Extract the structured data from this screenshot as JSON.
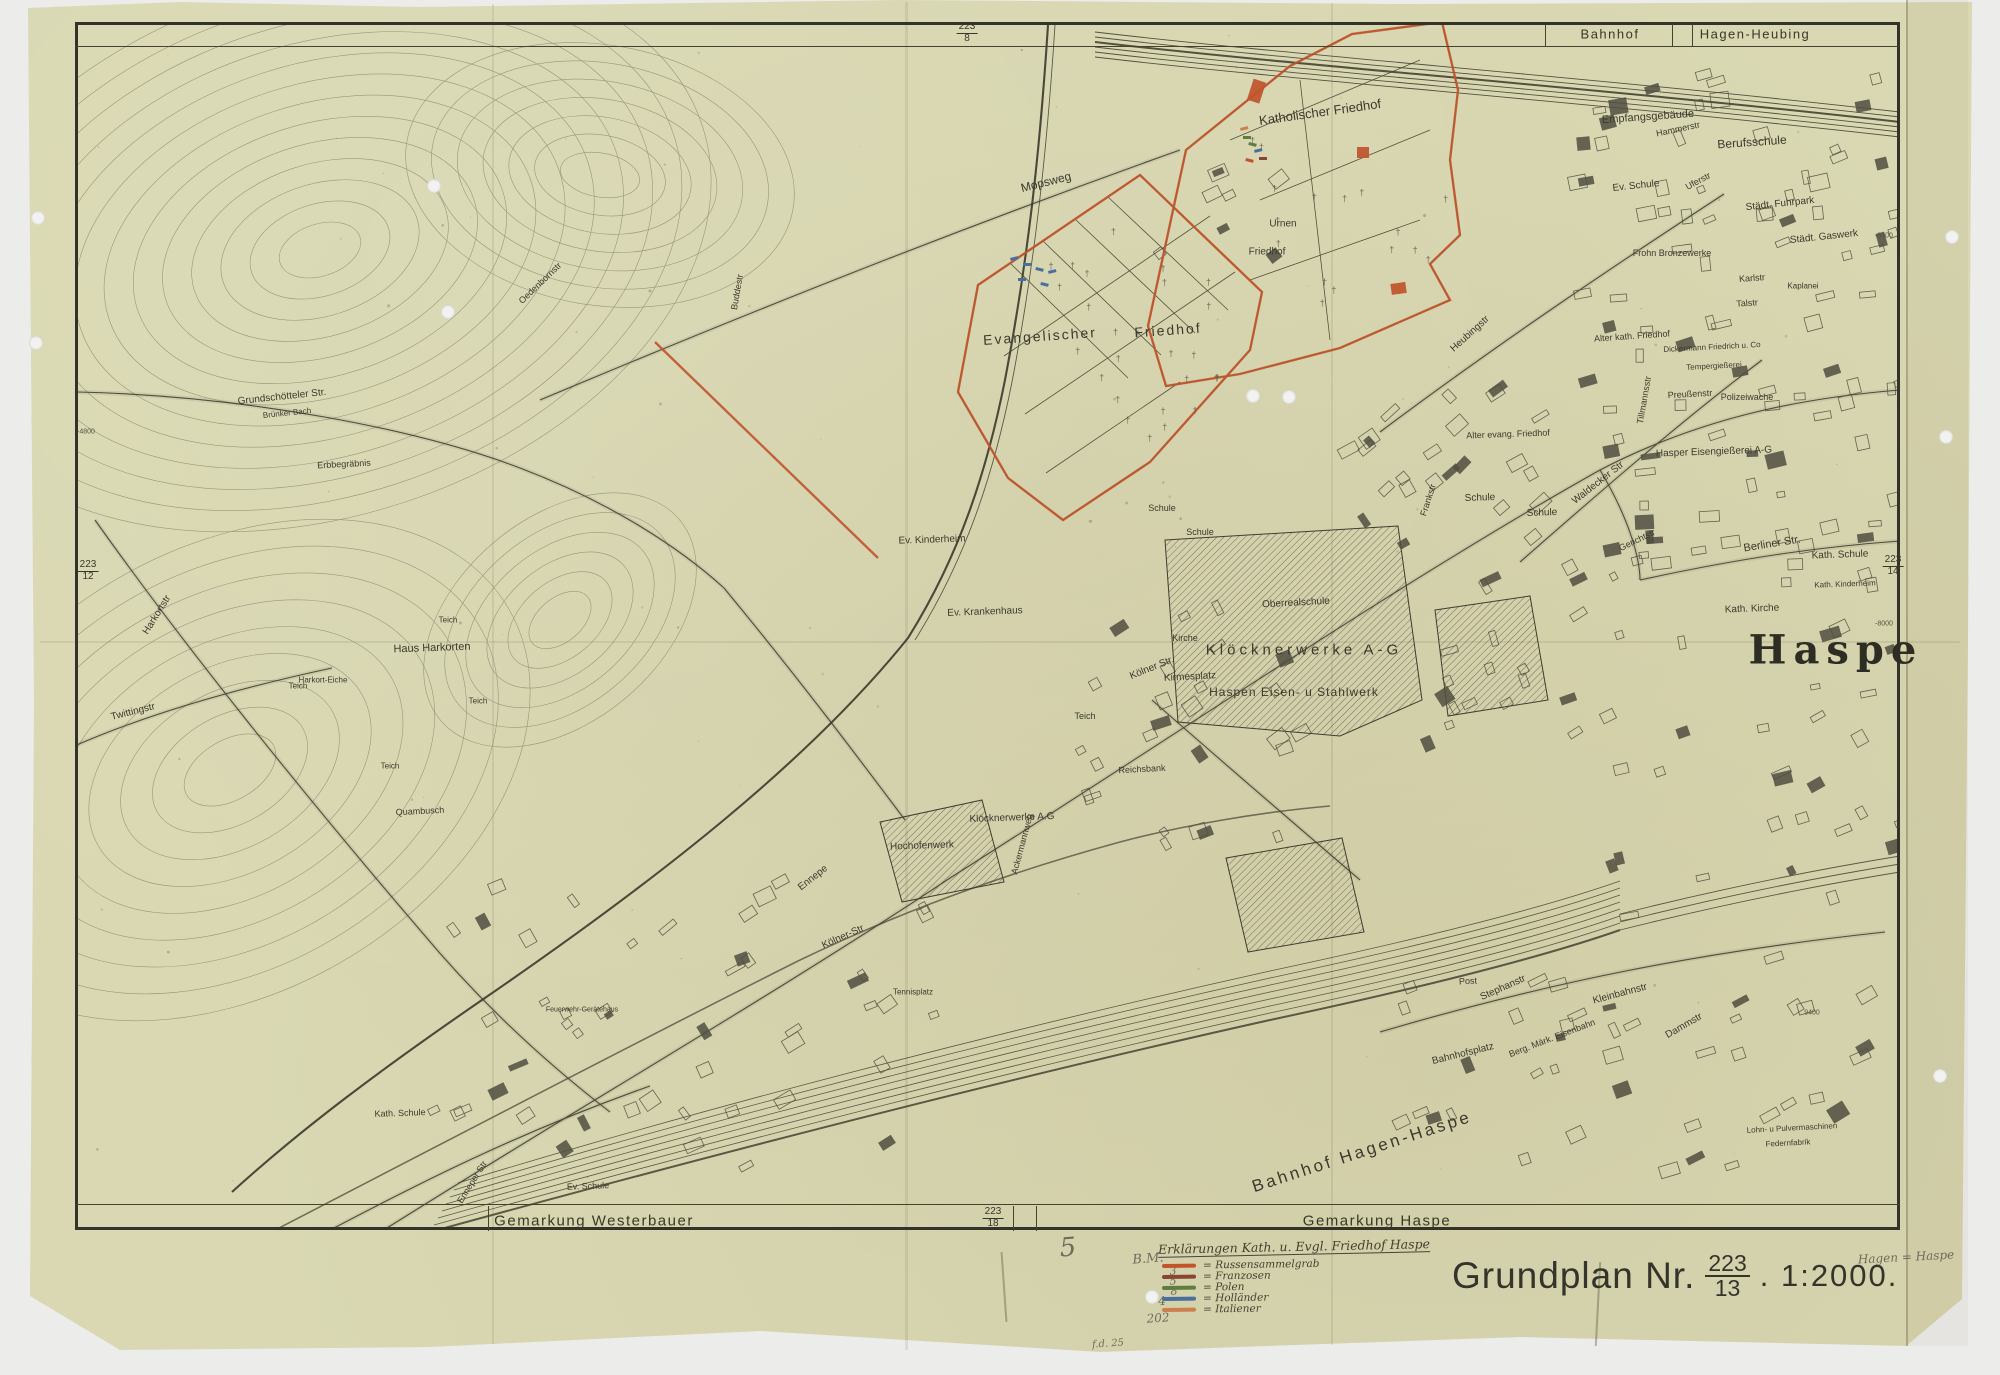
{
  "colors": {
    "paper": "#d9d8b2",
    "ink": "#3b392c",
    "overlay_red": "#c0542c",
    "legend_red": "#c4532b",
    "legend_brown": "#8a4531",
    "legend_green": "#5f7d3c",
    "legend_blue": "#4a6f9e",
    "legend_orange": "#cd7f4e",
    "pencil": "#6f6c5c"
  },
  "top_band": {
    "left": "Bahnhof",
    "right": "Hagen-Heubing"
  },
  "bottom_band": {
    "left": "Gemarkung Westerbauer",
    "right": "Gemarkung Haspe"
  },
  "sheet_refs": [
    {
      "num": "223",
      "den": "8",
      "x": 967,
      "y": 33
    },
    {
      "num": "223",
      "den": "12",
      "x": 88,
      "y": 571
    },
    {
      "num": "223",
      "den": "14",
      "x": 1893,
      "y": 566
    },
    {
      "num": "223",
      "den": "18",
      "x": 993,
      "y": 1218
    }
  ],
  "grid_labels": [
    {
      "t": "-4800",
      "x": 86,
      "y": 432
    },
    {
      "t": "-8400",
      "x": 1884,
      "y": 236
    },
    {
      "t": "-8000",
      "x": 1884,
      "y": 624
    },
    {
      "t": "9400",
      "x": 1812,
      "y": 1013
    }
  ],
  "map_labels": [
    {
      "t": "Katholischer Friedhof",
      "x": 1320,
      "y": 112,
      "r": -8,
      "s": 13
    },
    {
      "t": "Mopsweg",
      "x": 1046,
      "y": 182,
      "r": -14,
      "s": 12
    },
    {
      "t": "Urnen",
      "x": 1283,
      "y": 224,
      "r": 0,
      "s": 10
    },
    {
      "t": "Friedhof",
      "x": 1267,
      "y": 252,
      "r": 0,
      "s": 10
    },
    {
      "t": "Evangelischer",
      "x": 1040,
      "y": 336,
      "r": -4,
      "s": 14,
      "ls": 2
    },
    {
      "t": "Friedhof",
      "x": 1168,
      "y": 330,
      "r": -4,
      "s": 14,
      "ls": 2
    },
    {
      "t": "Empfangsgebäude",
      "x": 1648,
      "y": 117,
      "r": -4,
      "s": 11
    },
    {
      "t": "Hammerstr",
      "x": 1678,
      "y": 129,
      "r": -12,
      "s": 9
    },
    {
      "t": "Berufsschule",
      "x": 1752,
      "y": 142,
      "r": -4,
      "s": 12
    },
    {
      "t": "Ev. Schule",
      "x": 1636,
      "y": 186,
      "r": -6,
      "s": 10
    },
    {
      "t": "Uferstr",
      "x": 1698,
      "y": 181,
      "r": -28,
      "s": 9
    },
    {
      "t": "Städt. Fuhrpark",
      "x": 1780,
      "y": 204,
      "r": -6,
      "s": 10
    },
    {
      "t": "Städt. Gaswerk",
      "x": 1824,
      "y": 237,
      "r": -6,
      "s": 10
    },
    {
      "t": "Frohn Bronzewerke",
      "x": 1672,
      "y": 253,
      "r": 0,
      "s": 9
    },
    {
      "t": "Karlstr",
      "x": 1752,
      "y": 278,
      "r": -4,
      "s": 9
    },
    {
      "t": "Talstr",
      "x": 1747,
      "y": 303,
      "r": -4,
      "s": 9
    },
    {
      "t": "Kaplanei",
      "x": 1803,
      "y": 286,
      "r": 0,
      "s": 8
    },
    {
      "t": "Alter kath. Friedhof",
      "x": 1632,
      "y": 336,
      "r": -4,
      "s": 9
    },
    {
      "t": "Dickermann Friedrich u. Co",
      "x": 1712,
      "y": 347,
      "r": -3,
      "s": 8
    },
    {
      "t": "Tempergießerei",
      "x": 1714,
      "y": 366,
      "r": -3,
      "s": 8
    },
    {
      "t": "Preußenstr",
      "x": 1690,
      "y": 394,
      "r": -3,
      "s": 9
    },
    {
      "t": "Polizeiwache",
      "x": 1747,
      "y": 397,
      "r": 0,
      "s": 9
    },
    {
      "t": "Heubingstr",
      "x": 1470,
      "y": 334,
      "r": -42,
      "s": 10
    },
    {
      "t": "Tillmannsstr",
      "x": 1644,
      "y": 400,
      "r": -80,
      "s": 9
    },
    {
      "t": "Hasper Eisengießerei A-G",
      "x": 1714,
      "y": 452,
      "r": -2,
      "s": 10
    },
    {
      "t": "Waldecker Str",
      "x": 1598,
      "y": 483,
      "r": -38,
      "s": 10
    },
    {
      "t": "Alter evang. Friedhof",
      "x": 1508,
      "y": 434,
      "r": -2,
      "s": 9
    },
    {
      "t": "Schule",
      "x": 1480,
      "y": 498,
      "r": -2,
      "s": 10
    },
    {
      "t": "Schule",
      "x": 1542,
      "y": 513,
      "r": -2,
      "s": 10
    },
    {
      "t": "Schule",
      "x": 1162,
      "y": 508,
      "r": 0,
      "s": 9
    },
    {
      "t": "Schule",
      "x": 1200,
      "y": 532,
      "r": 0,
      "s": 9
    },
    {
      "t": "Frankstr",
      "x": 1428,
      "y": 500,
      "r": -72,
      "s": 9
    },
    {
      "t": "Gerichtstr",
      "x": 1637,
      "y": 540,
      "r": -26,
      "s": 9
    },
    {
      "t": "Berliner Str.",
      "x": 1772,
      "y": 544,
      "r": -9,
      "s": 11
    },
    {
      "t": "Kath. Schule",
      "x": 1840,
      "y": 555,
      "r": -2,
      "s": 10
    },
    {
      "t": "Kath. Kinderheim",
      "x": 1845,
      "y": 584,
      "r": -2,
      "s": 8
    },
    {
      "t": "Kath. Kirche",
      "x": 1752,
      "y": 609,
      "r": -2,
      "s": 10
    },
    {
      "t": "Haspe",
      "x": 1836,
      "y": 650,
      "r": 0,
      "s": 40,
      "f": "lg",
      "ls": 7
    },
    {
      "t": "Kirche",
      "x": 1185,
      "y": 638,
      "r": 0,
      "s": 9
    },
    {
      "t": "Kölner Str.",
      "x": 1152,
      "y": 668,
      "r": -22,
      "s": 10
    },
    {
      "t": "Oberrealschule",
      "x": 1296,
      "y": 603,
      "r": -3,
      "s": 10
    },
    {
      "t": "Kirmesplatz",
      "x": 1190,
      "y": 677,
      "r": -3,
      "s": 10
    },
    {
      "t": "Teich",
      "x": 1085,
      "y": 716,
      "r": 0,
      "s": 9
    },
    {
      "t": "Ev. Krankenhaus",
      "x": 985,
      "y": 612,
      "r": -2,
      "s": 10
    },
    {
      "t": "Ev. Kinderheim",
      "x": 932,
      "y": 540,
      "r": -2,
      "s": 10
    },
    {
      "t": "Klöcknerwerke A-G",
      "x": 1304,
      "y": 650,
      "r": 0,
      "s": 15,
      "ls": 4
    },
    {
      "t": "Haspen Eisen- u Stahlwerk",
      "x": 1294,
      "y": 692,
      "r": 0,
      "s": 12,
      "ls": 1
    },
    {
      "t": "Reichsbank",
      "x": 1142,
      "y": 769,
      "r": -3,
      "s": 9
    },
    {
      "t": "Ackermannweg",
      "x": 1022,
      "y": 844,
      "r": -75,
      "s": 9
    },
    {
      "t": "Klöcknerwerke A.G",
      "x": 1012,
      "y": 818,
      "r": -2,
      "s": 10
    },
    {
      "t": "Hochofenwerk",
      "x": 922,
      "y": 846,
      "r": -2,
      "s": 10
    },
    {
      "t": "Kölner-Str",
      "x": 843,
      "y": 937,
      "r": -24,
      "s": 10
    },
    {
      "t": "Ennepe",
      "x": 813,
      "y": 878,
      "r": -38,
      "s": 10
    },
    {
      "t": "Tennisplatz",
      "x": 913,
      "y": 992,
      "r": 0,
      "s": 8
    },
    {
      "t": "Post",
      "x": 1468,
      "y": 981,
      "r": -3,
      "s": 9
    },
    {
      "t": "Stephanstr",
      "x": 1503,
      "y": 988,
      "r": -24,
      "s": 10
    },
    {
      "t": "Kleinbahnstr",
      "x": 1620,
      "y": 994,
      "r": -15,
      "s": 10
    },
    {
      "t": "Berg. Märk. Eisenbahn",
      "x": 1552,
      "y": 1038,
      "r": -21,
      "s": 9
    },
    {
      "t": "Dammstr",
      "x": 1684,
      "y": 1026,
      "r": -30,
      "s": 10
    },
    {
      "t": "Bahnhofsplatz",
      "x": 1463,
      "y": 1054,
      "r": -14,
      "s": 10
    },
    {
      "t": "Bahnhof Hagen-Haspe",
      "x": 1362,
      "y": 1152,
      "r": -18,
      "s": 17,
      "ls": 3
    },
    {
      "t": "Lohn- u Pulvermaschinen",
      "x": 1792,
      "y": 1128,
      "r": -3,
      "s": 8
    },
    {
      "t": "Federnfabrik",
      "x": 1788,
      "y": 1143,
      "r": -3,
      "s": 8
    },
    {
      "t": "Ev. Schule",
      "x": 588,
      "y": 1186,
      "r": -2,
      "s": 9
    },
    {
      "t": "Enneper Str",
      "x": 472,
      "y": 1182,
      "r": -58,
      "s": 9
    },
    {
      "t": "Kath. Schule",
      "x": 400,
      "y": 1113,
      "r": -2,
      "s": 9
    },
    {
      "t": "Quambusch",
      "x": 420,
      "y": 811,
      "r": -3,
      "s": 9
    },
    {
      "t": "Feuerwehr-Gerätehaus",
      "x": 582,
      "y": 1010,
      "r": 0,
      "s": 7
    },
    {
      "t": "Teich",
      "x": 298,
      "y": 686,
      "r": 0,
      "s": 8
    },
    {
      "t": "Teich",
      "x": 478,
      "y": 701,
      "r": 0,
      "s": 8
    },
    {
      "t": "Teich",
      "x": 390,
      "y": 766,
      "r": 0,
      "s": 8
    },
    {
      "t": "Teich",
      "x": 448,
      "y": 620,
      "r": 0,
      "s": 8
    },
    {
      "t": "Haus Harkorten",
      "x": 432,
      "y": 648,
      "r": -2,
      "s": 11
    },
    {
      "t": "Harkort-Eiche",
      "x": 323,
      "y": 680,
      "r": 0,
      "s": 8
    },
    {
      "t": "Harkortstr",
      "x": 157,
      "y": 615,
      "r": -58,
      "s": 10
    },
    {
      "t": "Twittingstr",
      "x": 133,
      "y": 712,
      "r": -14,
      "s": 10
    },
    {
      "t": "Grundschötteler Str.",
      "x": 282,
      "y": 397,
      "r": -6,
      "s": 10
    },
    {
      "t": "Brünker Bach",
      "x": 287,
      "y": 413,
      "r": -6,
      "s": 8
    },
    {
      "t": "Erbbegräbnis",
      "x": 344,
      "y": 464,
      "r": -3,
      "s": 9
    },
    {
      "t": "Oedenbornstr",
      "x": 540,
      "y": 283,
      "r": -44,
      "s": 9
    },
    {
      "t": "Buddestr",
      "x": 737,
      "y": 292,
      "r": -80,
      "s": 9
    }
  ],
  "cemetery_marks": [
    {
      "x": 1240,
      "y": 128,
      "c": "#cd7f4e"
    },
    {
      "x": 1243,
      "y": 136,
      "c": "#5f7d3c"
    },
    {
      "x": 1249,
      "y": 142,
      "c": "#5f7d3c"
    },
    {
      "x": 1254,
      "y": 150,
      "c": "#4a6f9e"
    },
    {
      "x": 1259,
      "y": 157,
      "c": "#8a4531"
    },
    {
      "x": 1246,
      "y": 158,
      "c": "#c4532b"
    },
    {
      "x": 1010,
      "y": 258,
      "c": "#4a6f9e"
    },
    {
      "x": 1023,
      "y": 263,
      "c": "#4a6f9e"
    },
    {
      "x": 1036,
      "y": 267,
      "c": "#4a6f9e"
    },
    {
      "x": 1048,
      "y": 271,
      "c": "#4a6f9e"
    },
    {
      "x": 1018,
      "y": 278,
      "c": "#4a6f9e"
    },
    {
      "x": 1041,
      "y": 282,
      "c": "#4a6f9e"
    }
  ],
  "legend": {
    "title": "Erklärungen Kath. u. Evgl. Friedhof Haspe",
    "bullet": "=",
    "items": [
      {
        "color": "#c4532b",
        "label": "Russensammelgrab"
      },
      {
        "color": "#8a4531",
        "label": "Franzosen"
      },
      {
        "color": "#5f7d3c",
        "label": "Polen"
      },
      {
        "color": "#4a6f9e",
        "label": "Holländer"
      },
      {
        "color": "#cd7f4e",
        "label": "Italiener"
      }
    ],
    "annotations": [
      {
        "t": "5",
        "x": 1068,
        "y": 1248,
        "s": 26
      },
      {
        "t": "B.M.",
        "x": 1148,
        "y": 1259,
        "s": 13
      },
      {
        "t": "3",
        "x": 1173,
        "y": 1271,
        "s": 11
      },
      {
        "t": "5",
        "x": 1173,
        "y": 1281,
        "s": 11
      },
      {
        "t": "8",
        "x": 1174,
        "y": 1291,
        "s": 11
      },
      {
        "t": "4",
        "x": 1162,
        "y": 1301,
        "s": 12
      },
      {
        "t": "202",
        "x": 1158,
        "y": 1318,
        "s": 12
      },
      {
        "t": "f.d. 25",
        "x": 1108,
        "y": 1344,
        "s": 10
      }
    ]
  },
  "title_block": {
    "label": "Grundplan Nr.",
    "sheet_num": "223",
    "sheet_den": "13",
    "scale": ". 1:2000.",
    "pencil_note": "Hagen = Haspe"
  }
}
